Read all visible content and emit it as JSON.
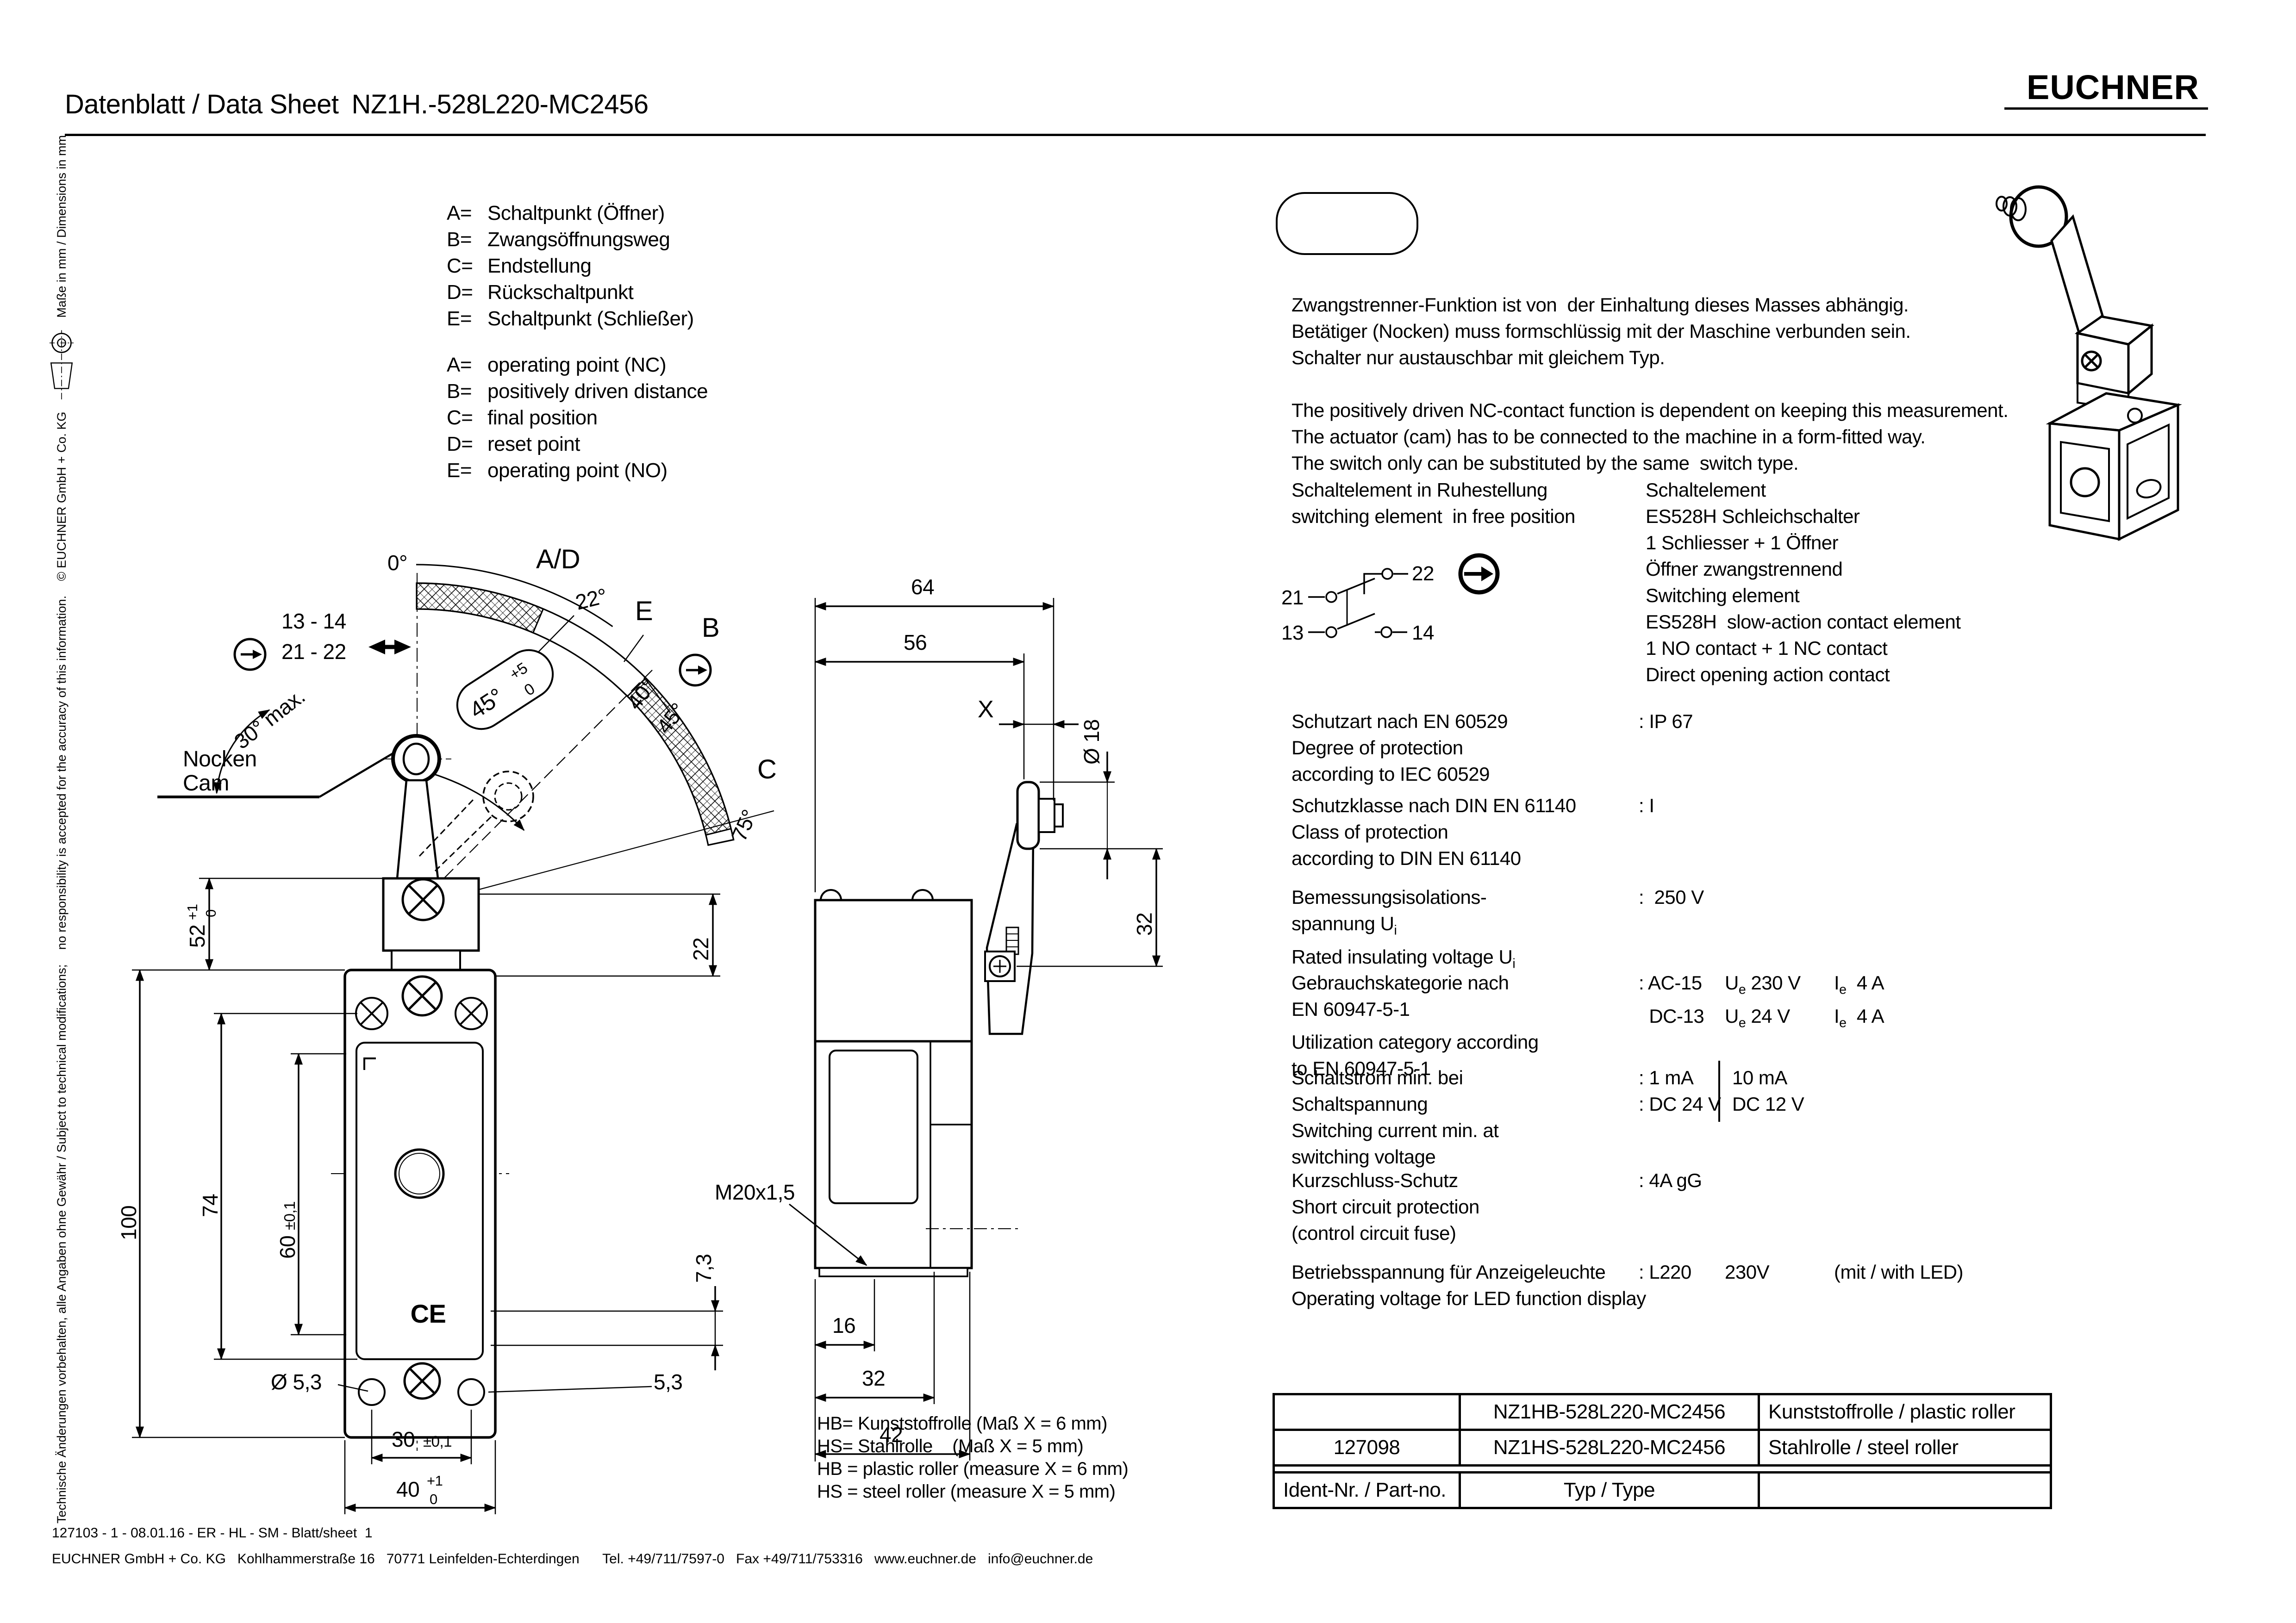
{
  "colors": {
    "ink": "#000000",
    "paper": "#ffffff"
  },
  "header": {
    "title_label": "Datenblatt / Data Sheet",
    "title_part": "NZ1H.-528L220-MC2456",
    "brand": "EUCHNER"
  },
  "sidebar": {
    "disclaimer_de": "Technische Änderungen vorbehalten, alle Angaben ohne Gewähr / Subject to technical modifications;",
    "disclaimer_en": "no responsibility is accepted for the accuracy of this information.",
    "copyright": "© EUCHNER GmbH + Co. KG",
    "dimensions_note": "Maße in mm / Dimensions in mm"
  },
  "legend": {
    "de": [
      {
        "k": "A=",
        "v": "Schaltpunkt (Öffner)"
      },
      {
        "k": "B=",
        "v": "Zwangsöffnungsweg"
      },
      {
        "k": "C=",
        "v": "Endstellung"
      },
      {
        "k": "D=",
        "v": "Rückschaltpunkt"
      },
      {
        "k": "E=",
        "v": "Schaltpunkt (Schließer)"
      }
    ],
    "en": [
      {
        "k": "A=",
        "v": "operating point (NC)"
      },
      {
        "k": "B=",
        "v": "positively driven distance"
      },
      {
        "k": "C=",
        "v": "final position"
      },
      {
        "k": "D=",
        "v": "reset point"
      },
      {
        "k": "E=",
        "v": "operating point (NO)"
      }
    ]
  },
  "notes": {
    "de": [
      "Zwangstrenner-Funktion ist von  der Einhaltung dieses Masses abhängig.",
      "Betätiger (Nocken) muss formschlüssig mit der Maschine verbunden sein.",
      "Schalter nur austauschbar mit gleichem Typ."
    ],
    "en": [
      "The positively driven NC-contact function is dependent on keeping this measurement.",
      "The actuator (cam) has to be connected to the machine in a form-fitted way.",
      "The switch only can be substituted by the same  switch type."
    ]
  },
  "switching": {
    "left_title_de": "Schaltelement in Ruhestellung",
    "left_title_en": "switching element  in free position",
    "right_lines": [
      "Schaltelement",
      "ES528H Schleichschalter",
      "1 Schliesser + 1 Öffner",
      "Öffner zwangstrennend",
      "Switching element",
      "ES528H  slow-action contact element",
      "1 NO contact + 1 NC contact",
      "Direct opening action contact"
    ],
    "t21": "21",
    "t22": "22",
    "t13": "13",
    "t14": "14"
  },
  "specs": [
    {
      "labels": [
        "Schutzart nach EN 60529",
        "Degree of protection",
        "according to IEC 60529"
      ],
      "value": ": IP 67"
    },
    {
      "labels": [
        "Schutzklasse nach DIN EN 61140",
        "Class of protection",
        "according to DIN EN 61140"
      ],
      "value": ": I"
    },
    {
      "labels": [
        "Bemessungsisolations-",
        "spannung U_i",
        "Rated insulating voltage U_i"
      ],
      "value": ":  250 V"
    },
    {
      "labels": [
        "Gebrauchskategorie nach",
        "EN 60947-5-1",
        "Utilization category according",
        "to EN 60947-5-1"
      ],
      "row1": [
        ": AC-15",
        "U_e 230 V",
        "I_e  4 A"
      ],
      "row2": [
        "  DC-13",
        "U_e 24 V",
        "I_e  4 A"
      ]
    },
    {
      "labels": [
        "Schaltstrom min. bei",
        "Schaltspannung",
        "Switching current min. at",
        "switching voltage"
      ],
      "row1": [
        ": 1 mA",
        "10 mA"
      ],
      "row2": [
        ": DC 24 V",
        "DC 12 V"
      ]
    },
    {
      "labels": [
        "Kurzschluss-Schutz",
        "Short circuit protection",
        "(control circuit fuse)"
      ],
      "value": ": 4A gG"
    },
    {
      "labels": [
        "Betriebsspannung für Anzeigeleuchte",
        "Operating voltage for LED function display"
      ],
      "row1": [
        ": L220",
        "230V",
        "(mit / with LED)"
      ]
    }
  ],
  "table": {
    "rows": [
      [
        "",
        "NZ1HB-528L220-MC2456",
        "Kunststoffrolle / plastic roller"
      ],
      [
        "127098",
        "NZ1HS-528L220-MC2456",
        "Stahlrolle / steel roller"
      ],
      [
        "Ident-Nr. / Part-no.",
        "Typ / Type",
        ""
      ]
    ]
  },
  "roller_legend": [
    "HB= Kunststoffrolle (Maß X = 6 mm)",
    "HS= Stahlrolle    (Maß X = 5 mm)",
    "HB = plastic roller (measure X = 6 mm)",
    "HS = steel roller (measure X = 5 mm)"
  ],
  "footer": {
    "line1": "127103 - 1 - 08.01.16 - ER - HL - SM - Blatt/sheet  1",
    "line2": "EUCHNER GmbH + Co. KG   Kohlhammerstraße 16   70771 Leinfelden-Echterdingen      Tel. +49/711/7597-0   Fax +49/711/753316   www.euchner.de   info@euchner.de"
  },
  "drawing": {
    "left": {
      "zero": "0°",
      "ad": "A/D",
      "deg22": "22°",
      "e": "E",
      "deg40": "40°",
      "b": "B",
      "deg45": "45°",
      "c": "C",
      "deg75": "75°",
      "tol45": "45°",
      "tol45_sup": "+5",
      "tol45_sub": "0",
      "contacts1": "13 - 14",
      "contacts2": "21 - 22",
      "max30": "30° max.",
      "nocken": "Nocken",
      "cam": "Cam",
      "d52": "52",
      "d52_sup": "+1",
      "d52_sub": "0",
      "d100": "100",
      "d74": "74",
      "d60": "60",
      "d60_tol": "±0,1",
      "d22": "22",
      "d73": "7,3",
      "dia53": "Ø 5,3",
      "d53": "5,3",
      "d30": "30",
      "d30_tol": "±0,1",
      "d40": "40",
      "d40_sup": "+1",
      "d40_sub": "0"
    },
    "middle": {
      "d64": "64",
      "d56": "56",
      "x": "X",
      "dia18": "Ø 18",
      "d32v": "32",
      "m20": "M20x1,5",
      "d16": "16",
      "d32": "32",
      "d42": "42"
    }
  }
}
